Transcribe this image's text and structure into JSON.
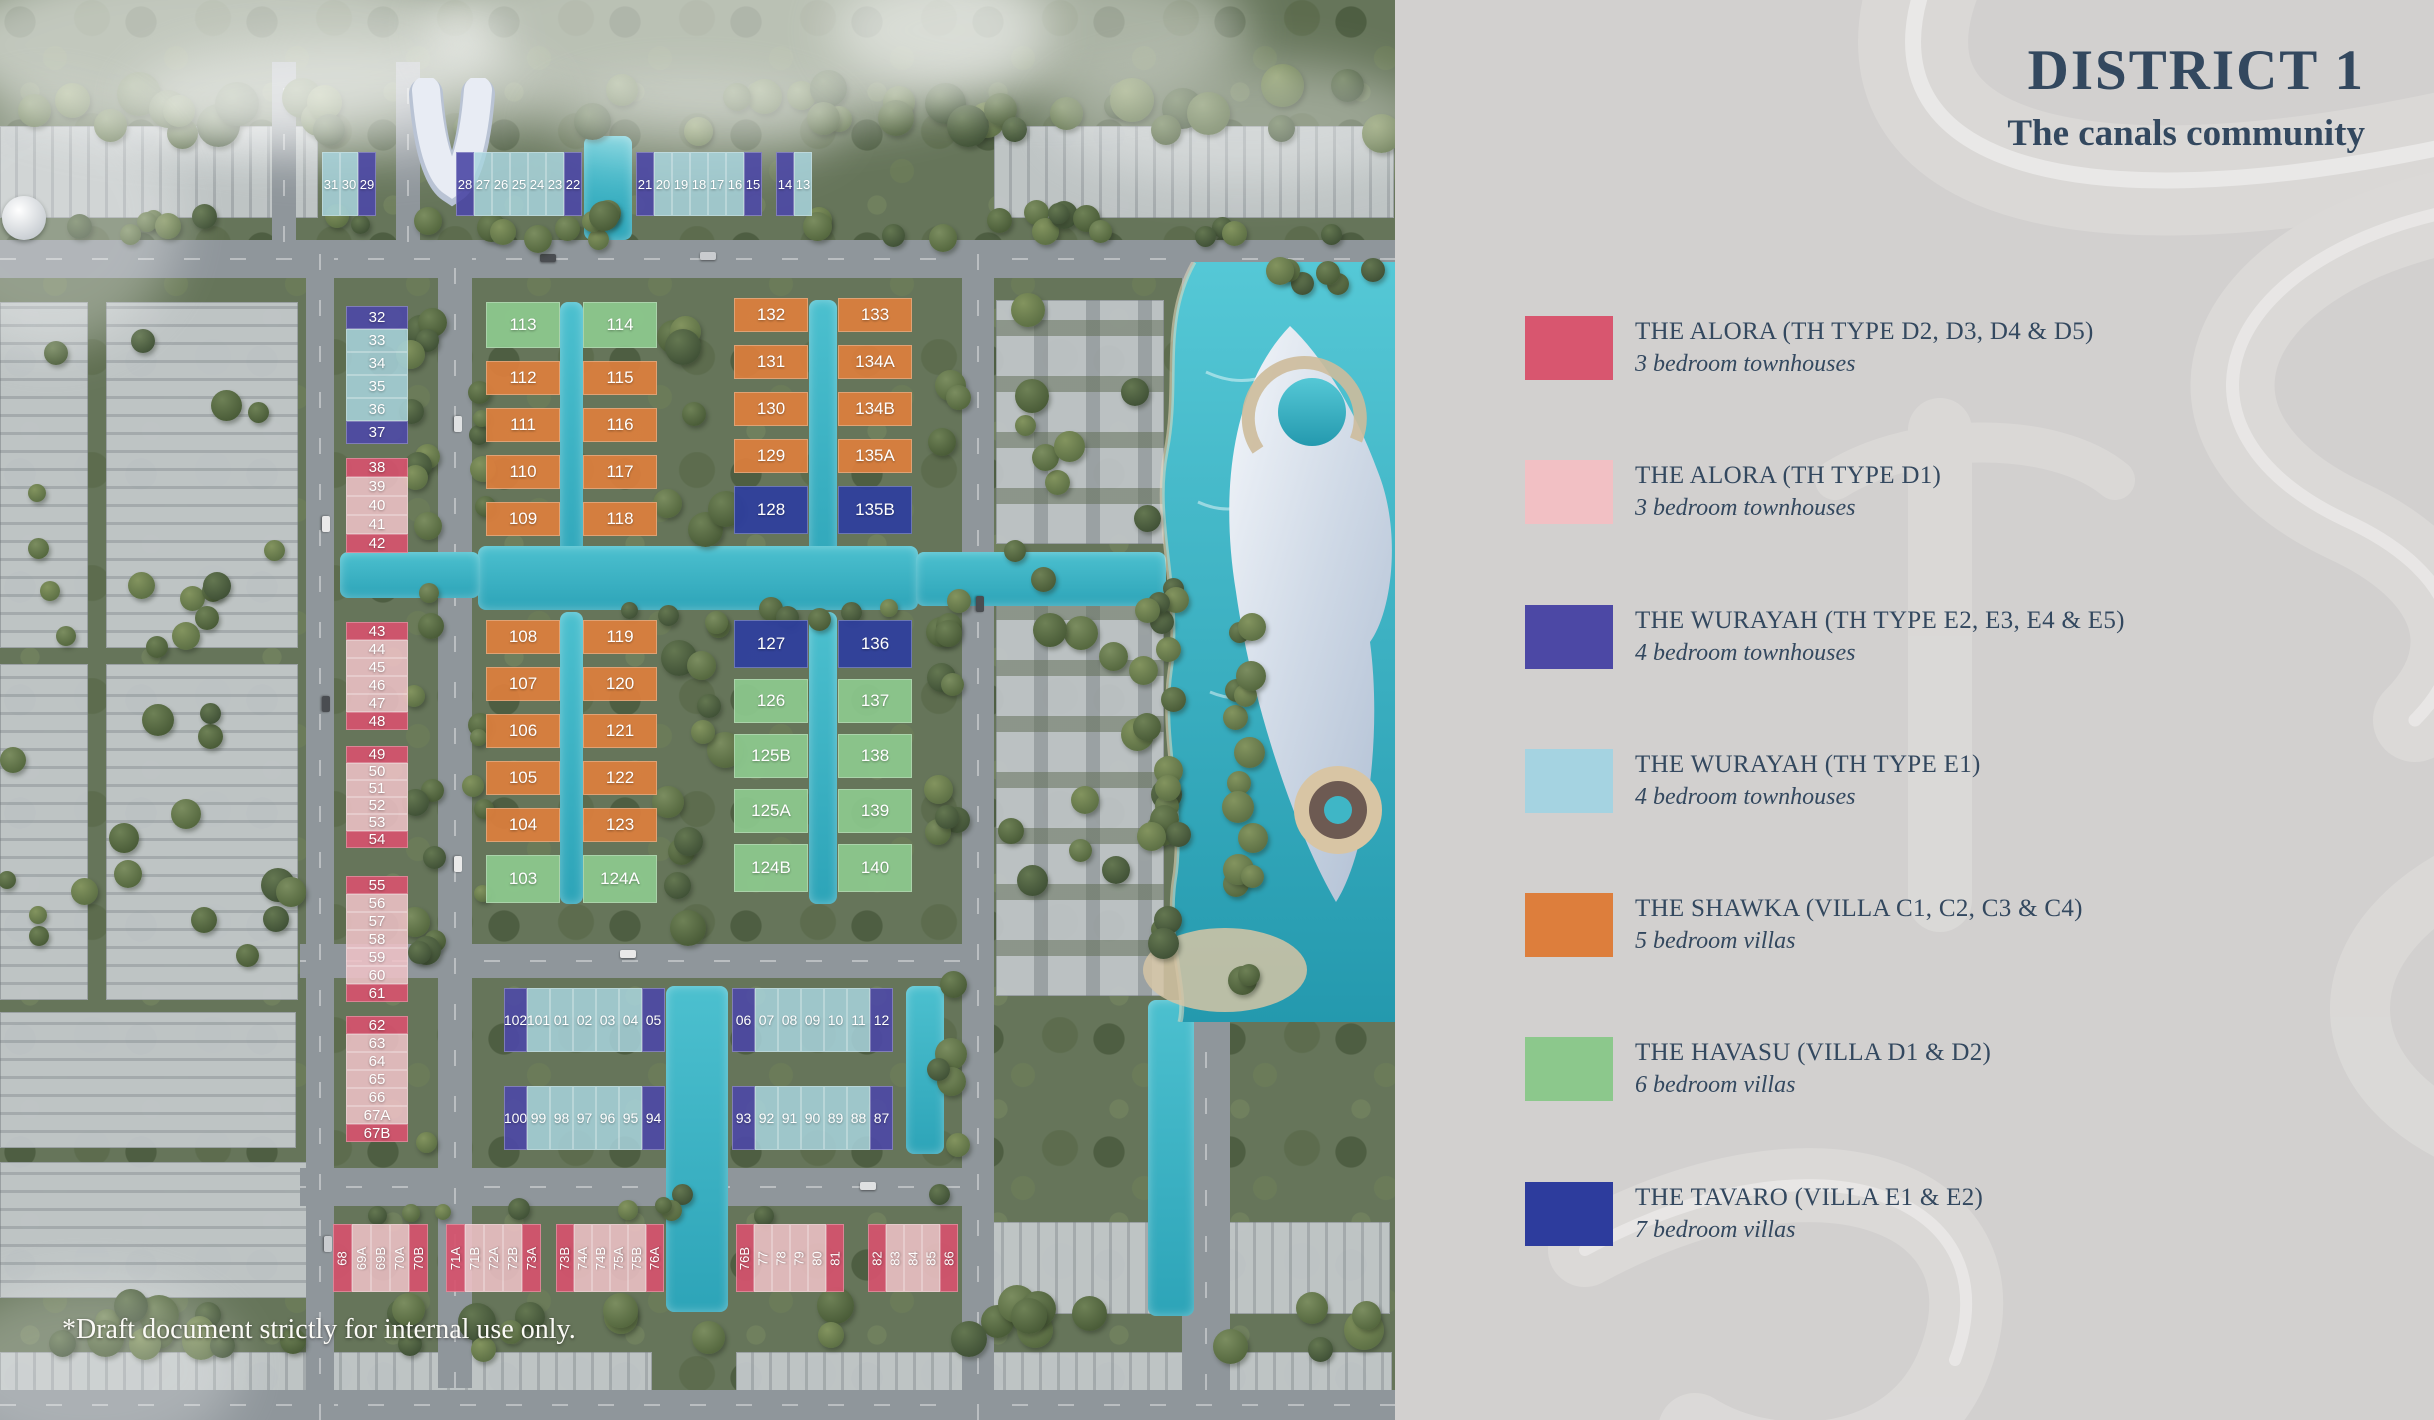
{
  "panel": {
    "title": "DISTRICT 1",
    "subtitle": "The canals community",
    "bg": "#d2d0cf",
    "text_color": "#33485f",
    "legend": [
      {
        "name": "THE ALORA (TH TYPE D2, D3, D4 & D5)",
        "sub": "3 bedroom townhouses",
        "color": "#d8566f",
        "key": "crimson"
      },
      {
        "name": "THE ALORA (TH TYPE D1)",
        "sub": "3 bedroom townhouses",
        "color": "#f2c0c4",
        "key": "pink"
      },
      {
        "name": "THE WURAYAH (TH TYPE E2, E3, E4 & E5)",
        "sub": "4 bedroom townhouses",
        "color": "#4c48a5",
        "key": "indigo"
      },
      {
        "name": "THE WURAYAH (TH TYPE E1)",
        "sub": "4 bedroom townhouses",
        "color": "#a5d3e1",
        "key": "lightblue"
      },
      {
        "name": "THE SHAWKA (VILLA C1, C2, C3 & C4)",
        "sub": "5 bedroom villas",
        "color": "#dd7e3c",
        "key": "orange"
      },
      {
        "name": "THE HAVASU (VILLA D1 & D2)",
        "sub": "6 bedroom villas",
        "color": "#8cc88c",
        "key": "green"
      },
      {
        "name": "THE TAVARO (VILLA E1 & E2)",
        "sub": "7 bedroom villas",
        "color": "#2d3c9d",
        "key": "navy"
      }
    ]
  },
  "map": {
    "footnote": "*Draft document strictly for internal use only.",
    "water_color": "#35aec2",
    "lot_colors": {
      "crimson": "#d4536dee",
      "pink": "#eec2c6e0",
      "indigo": "#4d49a6e8",
      "lightblue": "#a9d4ded8",
      "orange": "#dc7e3dee",
      "green": "#8cc88dee",
      "navy": "#2e3e9eee"
    },
    "lot_groups": [
      {
        "id": "top-a",
        "x": 322,
        "y": 152,
        "dir": "row",
        "w": 18,
        "h": 64,
        "gap": 0,
        "fs": 13,
        "rot": 0,
        "lots": [
          [
            "31",
            "lightblue"
          ],
          [
            "30",
            "lightblue"
          ],
          [
            "29",
            "indigo"
          ]
        ]
      },
      {
        "id": "top-b",
        "x": 456,
        "y": 152,
        "dir": "row",
        "w": 18,
        "h": 64,
        "gap": 0,
        "fs": 13,
        "rot": 0,
        "lots": [
          [
            "28",
            "indigo"
          ],
          [
            "27",
            "lightblue"
          ],
          [
            "26",
            "lightblue"
          ],
          [
            "25",
            "lightblue"
          ],
          [
            "24",
            "lightblue"
          ],
          [
            "23",
            "lightblue"
          ],
          [
            "22",
            "indigo"
          ]
        ]
      },
      {
        "id": "top-c",
        "x": 636,
        "y": 152,
        "dir": "row",
        "w": 18,
        "h": 64,
        "gap": 0,
        "fs": 13,
        "rot": 0,
        "lots": [
          [
            "21",
            "indigo"
          ],
          [
            "20",
            "lightblue"
          ],
          [
            "19",
            "lightblue"
          ],
          [
            "18",
            "lightblue"
          ],
          [
            "17",
            "lightblue"
          ],
          [
            "16",
            "lightblue"
          ],
          [
            "15",
            "indigo"
          ]
        ]
      },
      {
        "id": "top-d",
        "x": 776,
        "y": 152,
        "dir": "row",
        "w": 18,
        "h": 64,
        "gap": 0,
        "fs": 13,
        "rot": 0,
        "lots": [
          [
            "14",
            "indigo"
          ],
          [
            "13",
            "lightblue"
          ]
        ]
      },
      {
        "id": "left-1",
        "x": 346,
        "y": 306,
        "dir": "col",
        "w": 62,
        "h": 23,
        "gap": 0,
        "fs": 15,
        "rot": 0,
        "lots": [
          [
            "32",
            "indigo"
          ],
          [
            "33",
            "lightblue"
          ],
          [
            "34",
            "lightblue"
          ],
          [
            "35",
            "lightblue"
          ],
          [
            "36",
            "lightblue"
          ],
          [
            "37",
            "indigo"
          ]
        ]
      },
      {
        "id": "left-2",
        "x": 346,
        "y": 458,
        "dir": "col",
        "w": 62,
        "h": 19,
        "gap": 0,
        "fs": 15,
        "rot": 0,
        "lots": [
          [
            "38",
            "crimson"
          ],
          [
            "39",
            "pink"
          ],
          [
            "40",
            "pink"
          ],
          [
            "41",
            "pink"
          ],
          [
            "42",
            "crimson"
          ]
        ]
      },
      {
        "id": "left-3",
        "x": 346,
        "y": 622,
        "dir": "col",
        "w": 62,
        "h": 18,
        "gap": 0,
        "fs": 15,
        "rot": 0,
        "lots": [
          [
            "43",
            "crimson"
          ],
          [
            "44",
            "pink"
          ],
          [
            "45",
            "pink"
          ],
          [
            "46",
            "pink"
          ],
          [
            "47",
            "pink"
          ],
          [
            "48",
            "crimson"
          ]
        ]
      },
      {
        "id": "left-4",
        "x": 346,
        "y": 746,
        "dir": "col",
        "w": 62,
        "h": 17,
        "gap": 0,
        "fs": 15,
        "rot": 0,
        "lots": [
          [
            "49",
            "crimson"
          ],
          [
            "50",
            "pink"
          ],
          [
            "51",
            "pink"
          ],
          [
            "52",
            "pink"
          ],
          [
            "53",
            "pink"
          ],
          [
            "54",
            "crimson"
          ]
        ]
      },
      {
        "id": "left-5",
        "x": 346,
        "y": 876,
        "dir": "col",
        "w": 62,
        "h": 18,
        "gap": 0,
        "fs": 15,
        "rot": 0,
        "lots": [
          [
            "55",
            "crimson"
          ],
          [
            "56",
            "pink"
          ],
          [
            "57",
            "pink"
          ],
          [
            "58",
            "pink"
          ],
          [
            "59",
            "pink"
          ],
          [
            "60",
            "pink"
          ],
          [
            "61",
            "crimson"
          ]
        ]
      },
      {
        "id": "left-6",
        "x": 346,
        "y": 1016,
        "dir": "col",
        "w": 62,
        "h": 18,
        "gap": 0,
        "fs": 15,
        "rot": 0,
        "lots": [
          [
            "62",
            "crimson"
          ],
          [
            "63",
            "pink"
          ],
          [
            "64",
            "pink"
          ],
          [
            "65",
            "pink"
          ],
          [
            "66",
            "pink"
          ],
          [
            "67A",
            "pink"
          ],
          [
            "67B",
            "crimson"
          ]
        ]
      },
      {
        "id": "villa-1a",
        "x": 486,
        "y": 302,
        "dir": "col",
        "w": 74,
        "h": 34,
        "gap": 13,
        "fs": 17,
        "rot": 0,
        "lots": [
          [
            "113",
            "green",
            46
          ],
          [
            "112",
            "orange"
          ],
          [
            "111",
            "orange"
          ],
          [
            "110",
            "orange"
          ],
          [
            "109",
            "orange"
          ]
        ]
      },
      {
        "id": "villa-1b",
        "x": 583,
        "y": 302,
        "dir": "col",
        "w": 74,
        "h": 34,
        "gap": 13,
        "fs": 17,
        "rot": 0,
        "lots": [
          [
            "114",
            "green",
            46
          ],
          [
            "115",
            "orange"
          ],
          [
            "116",
            "orange"
          ],
          [
            "117",
            "orange"
          ],
          [
            "118",
            "orange"
          ]
        ]
      },
      {
        "id": "villa-1c",
        "x": 486,
        "y": 620,
        "dir": "col",
        "w": 74,
        "h": 34,
        "gap": 13,
        "fs": 17,
        "rot": 0,
        "lots": [
          [
            "108",
            "orange"
          ],
          [
            "107",
            "orange"
          ],
          [
            "106",
            "orange"
          ],
          [
            "105",
            "orange"
          ],
          [
            "104",
            "orange"
          ],
          [
            "103",
            "green",
            48
          ]
        ]
      },
      {
        "id": "villa-1d",
        "x": 583,
        "y": 620,
        "dir": "col",
        "w": 74,
        "h": 34,
        "gap": 13,
        "fs": 17,
        "rot": 0,
        "lots": [
          [
            "119",
            "orange"
          ],
          [
            "120",
            "orange"
          ],
          [
            "121",
            "orange"
          ],
          [
            "122",
            "orange"
          ],
          [
            "123",
            "orange"
          ],
          [
            "124A",
            "green",
            48
          ]
        ]
      },
      {
        "id": "villa-2a",
        "x": 734,
        "y": 298,
        "dir": "col",
        "w": 74,
        "h": 34,
        "gap": 13,
        "fs": 17,
        "rot": 0,
        "lots": [
          [
            "132",
            "orange"
          ],
          [
            "131",
            "orange"
          ],
          [
            "130",
            "orange"
          ],
          [
            "129",
            "orange"
          ],
          [
            "128",
            "navy",
            48
          ]
        ]
      },
      {
        "id": "villa-2b",
        "x": 838,
        "y": 298,
        "dir": "col",
        "w": 74,
        "h": 34,
        "gap": 13,
        "fs": 17,
        "rot": 0,
        "lots": [
          [
            "133",
            "orange"
          ],
          [
            "134A",
            "orange"
          ],
          [
            "134B",
            "orange"
          ],
          [
            "135A",
            "orange"
          ],
          [
            "135B",
            "navy",
            48
          ]
        ]
      },
      {
        "id": "villa-2c",
        "x": 734,
        "y": 620,
        "dir": "col",
        "w": 74,
        "h": 44,
        "gap": 11,
        "fs": 17,
        "rot": 0,
        "lots": [
          [
            "127",
            "navy",
            48
          ],
          [
            "126",
            "green"
          ],
          [
            "125B",
            "green"
          ],
          [
            "125A",
            "green"
          ],
          [
            "124B",
            "green",
            48
          ]
        ]
      },
      {
        "id": "villa-2d",
        "x": 838,
        "y": 620,
        "dir": "col",
        "w": 74,
        "h": 44,
        "gap": 11,
        "fs": 17,
        "rot": 0,
        "lots": [
          [
            "136",
            "navy",
            48
          ],
          [
            "137",
            "green"
          ],
          [
            "138",
            "green"
          ],
          [
            "139",
            "green"
          ],
          [
            "140",
            "green",
            48
          ]
        ]
      },
      {
        "id": "mid-1l",
        "x": 504,
        "y": 988,
        "dir": "row",
        "w": 23,
        "h": 64,
        "gap": 0,
        "fs": 14,
        "rot": 0,
        "lots": [
          [
            "102",
            "indigo"
          ],
          [
            "101",
            "lightblue"
          ],
          [
            "01",
            "lightblue"
          ],
          [
            "02",
            "lightblue"
          ],
          [
            "03",
            "lightblue"
          ],
          [
            "04",
            "lightblue"
          ],
          [
            "05",
            "indigo"
          ]
        ]
      },
      {
        "id": "mid-1r",
        "x": 732,
        "y": 988,
        "dir": "row",
        "w": 23,
        "h": 64,
        "gap": 0,
        "fs": 14,
        "rot": 0,
        "lots": [
          [
            "06",
            "indigo"
          ],
          [
            "07",
            "lightblue"
          ],
          [
            "08",
            "lightblue"
          ],
          [
            "09",
            "lightblue"
          ],
          [
            "10",
            "lightblue"
          ],
          [
            "11",
            "lightblue"
          ],
          [
            "12",
            "indigo"
          ]
        ]
      },
      {
        "id": "mid-2l",
        "x": 504,
        "y": 1086,
        "dir": "row",
        "w": 23,
        "h": 64,
        "gap": 0,
        "fs": 14,
        "rot": 0,
        "lots": [
          [
            "100",
            "indigo"
          ],
          [
            "99",
            "lightblue"
          ],
          [
            "98",
            "lightblue"
          ],
          [
            "97",
            "lightblue"
          ],
          [
            "96",
            "lightblue"
          ],
          [
            "95",
            "lightblue"
          ],
          [
            "94",
            "indigo"
          ]
        ]
      },
      {
        "id": "mid-2r",
        "x": 732,
        "y": 1086,
        "dir": "row",
        "w": 23,
        "h": 64,
        "gap": 0,
        "fs": 14,
        "rot": 0,
        "lots": [
          [
            "93",
            "indigo"
          ],
          [
            "92",
            "lightblue"
          ],
          [
            "91",
            "lightblue"
          ],
          [
            "90",
            "lightblue"
          ],
          [
            "89",
            "lightblue"
          ],
          [
            "88",
            "lightblue"
          ],
          [
            "87",
            "indigo"
          ]
        ]
      },
      {
        "id": "bot-a",
        "x": 333,
        "y": 1224,
        "dir": "row",
        "w": 19,
        "h": 68,
        "gap": 0,
        "fs": 13,
        "rot": -90,
        "lots": [
          [
            "68",
            "crimson"
          ],
          [
            "69A",
            "pink"
          ],
          [
            "69B",
            "pink"
          ],
          [
            "70A",
            "pink"
          ],
          [
            "70B",
            "crimson"
          ]
        ]
      },
      {
        "id": "bot-b",
        "x": 446,
        "y": 1224,
        "dir": "row",
        "w": 19,
        "h": 68,
        "gap": 0,
        "fs": 13,
        "rot": -90,
        "lots": [
          [
            "71A",
            "crimson"
          ],
          [
            "71B",
            "pink"
          ],
          [
            "72A",
            "pink"
          ],
          [
            "72B",
            "pink"
          ],
          [
            "73A",
            "crimson"
          ]
        ]
      },
      {
        "id": "bot-c",
        "x": 556,
        "y": 1224,
        "dir": "row",
        "w": 18,
        "h": 68,
        "gap": 0,
        "fs": 13,
        "rot": -90,
        "lots": [
          [
            "73B",
            "crimson"
          ],
          [
            "74A",
            "pink"
          ],
          [
            "74B",
            "pink"
          ],
          [
            "75A",
            "pink"
          ],
          [
            "75B",
            "pink"
          ],
          [
            "76A",
            "crimson"
          ]
        ]
      },
      {
        "id": "bot-d",
        "x": 736,
        "y": 1224,
        "dir": "row",
        "w": 18,
        "h": 68,
        "gap": 0,
        "fs": 13,
        "rot": -90,
        "lots": [
          [
            "76B",
            "crimson"
          ],
          [
            "77",
            "pink"
          ],
          [
            "78",
            "pink"
          ],
          [
            "79",
            "pink"
          ],
          [
            "80",
            "pink"
          ],
          [
            "81",
            "crimson"
          ]
        ]
      },
      {
        "id": "bot-e",
        "x": 868,
        "y": 1224,
        "dir": "row",
        "w": 18,
        "h": 68,
        "gap": 0,
        "fs": 13,
        "rot": -90,
        "lots": [
          [
            "82",
            "crimson"
          ],
          [
            "83",
            "pink"
          ],
          [
            "84",
            "pink"
          ],
          [
            "85",
            "pink"
          ],
          [
            "86",
            "crimson"
          ]
        ]
      }
    ]
  }
}
